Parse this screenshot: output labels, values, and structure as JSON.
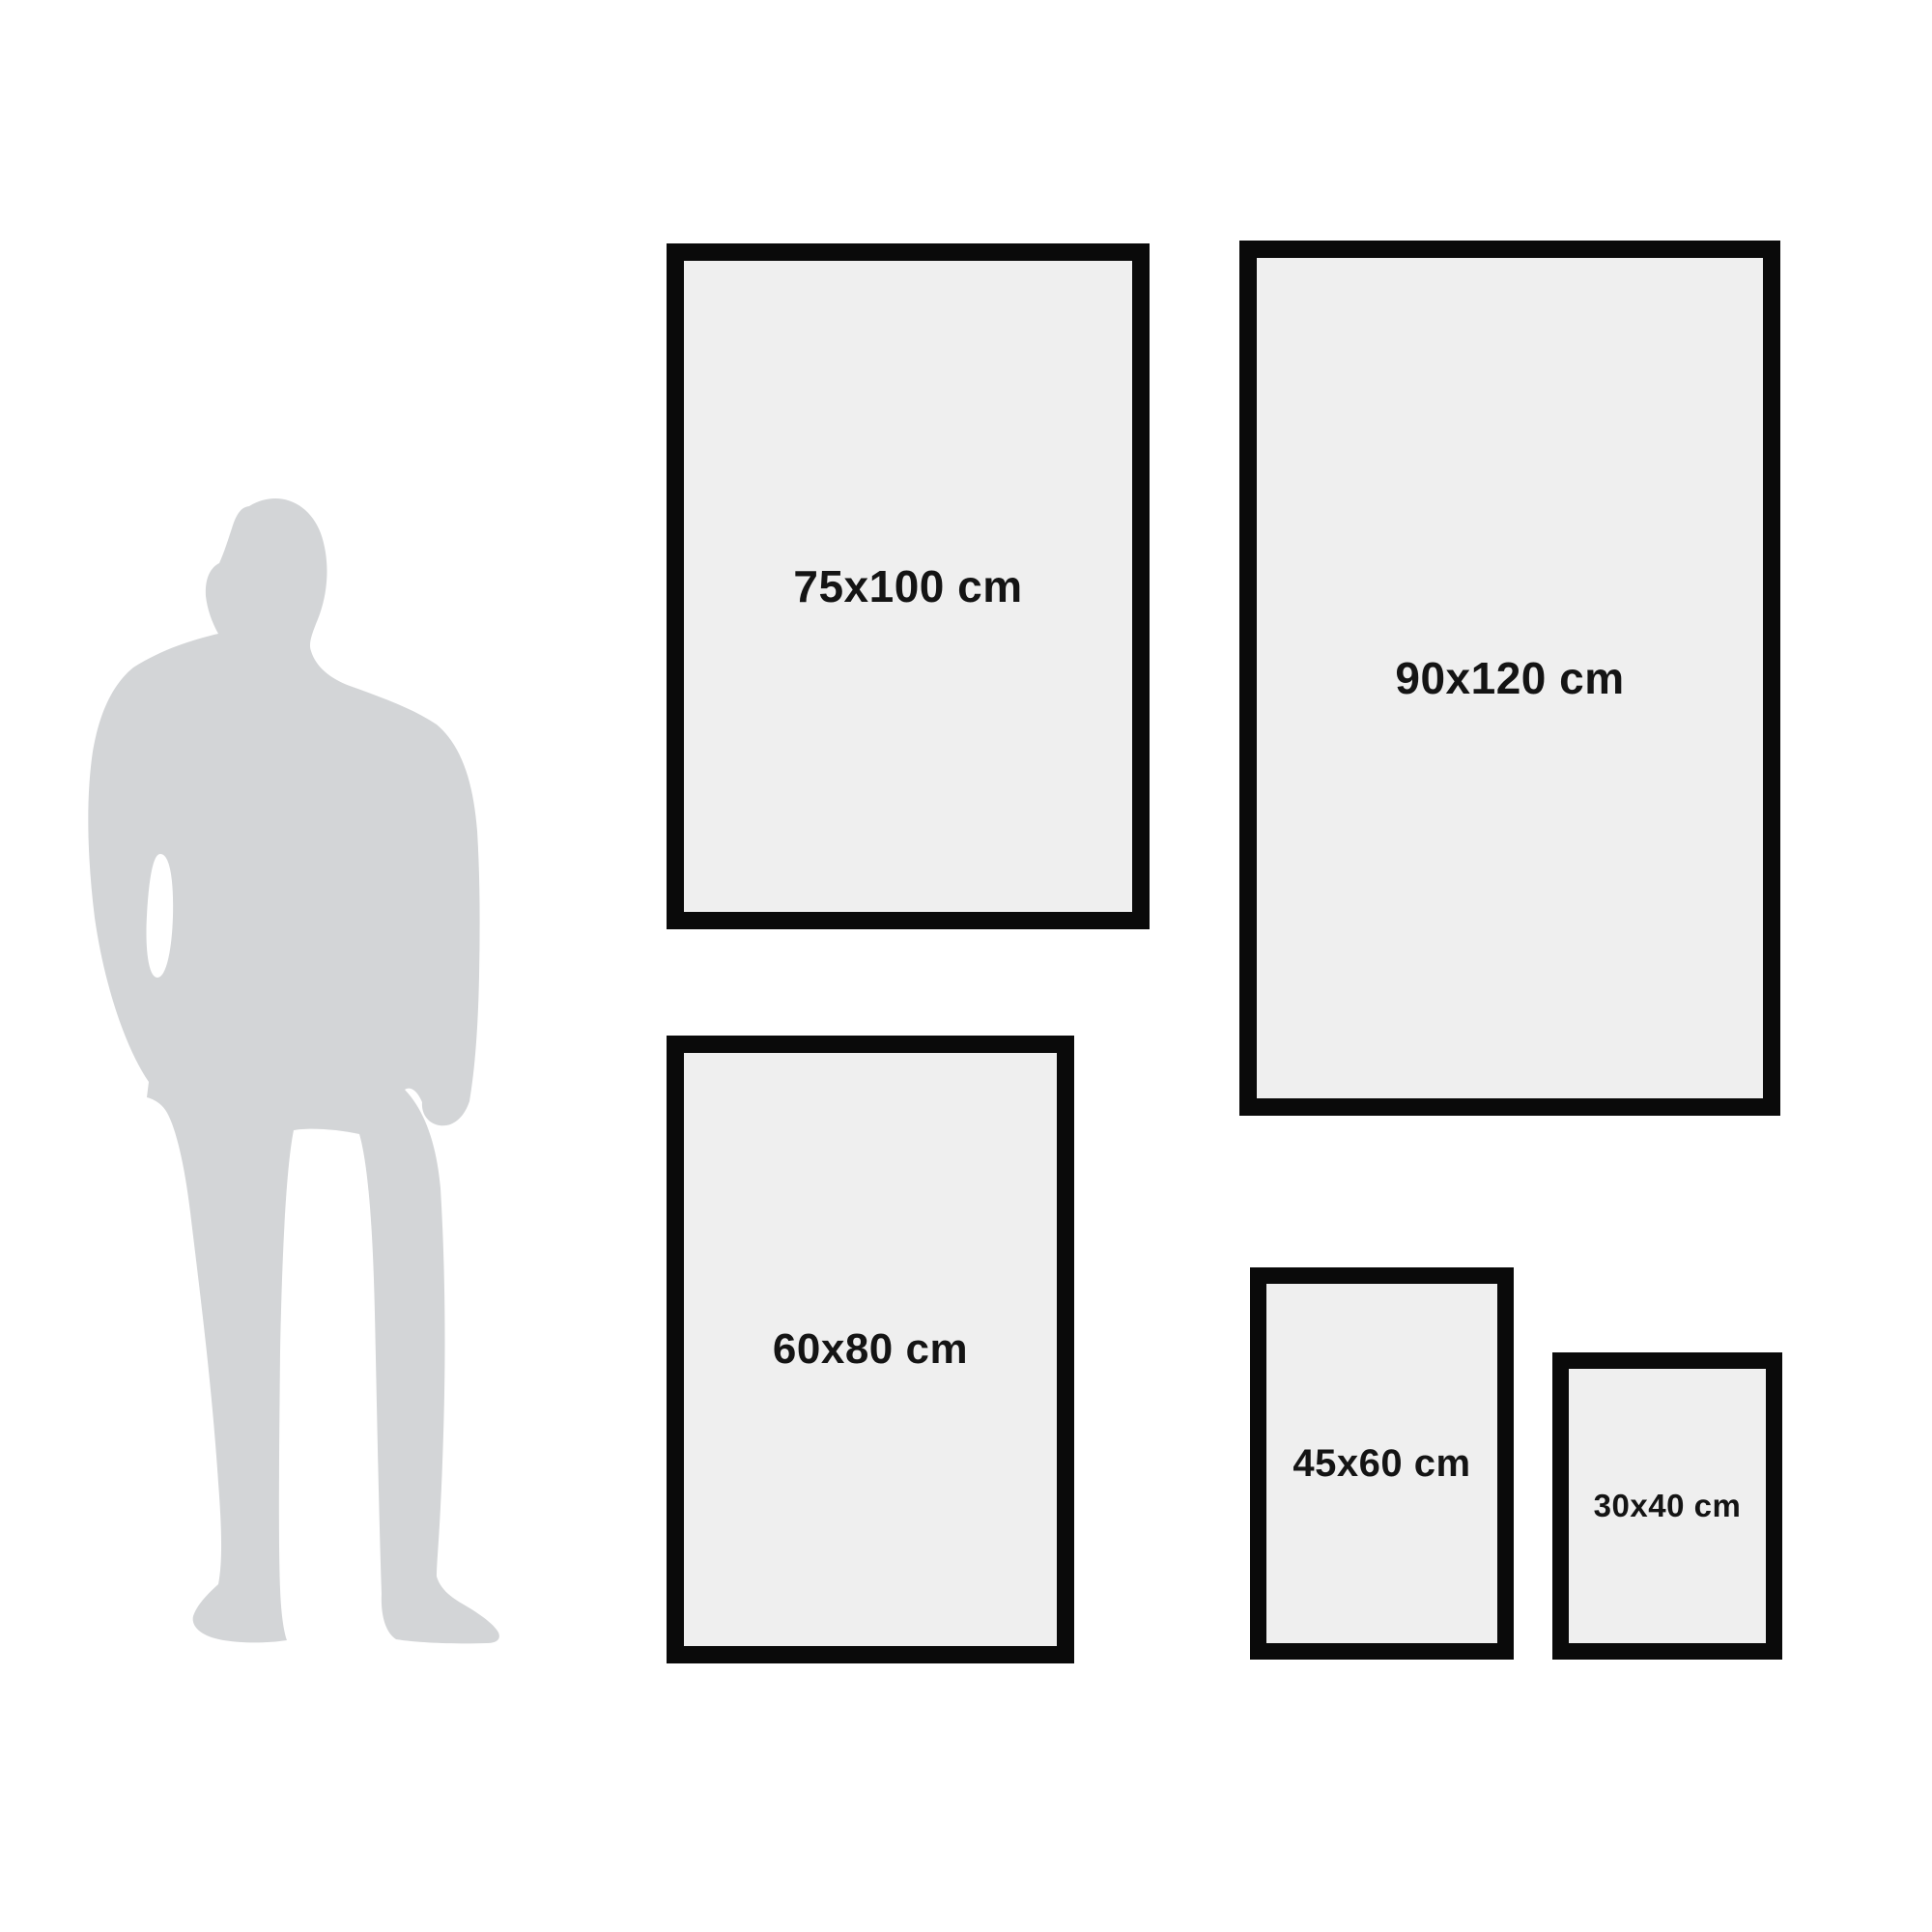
{
  "diagram": {
    "description": "Poster frame size comparison with human silhouette for scale",
    "silhouette_icon": "man-silhouette",
    "frames": [
      {
        "label": "75x100 cm",
        "width_cm": 75,
        "height_cm": 100
      },
      {
        "label": "90x120 cm",
        "width_cm": 90,
        "height_cm": 120
      },
      {
        "label": "60x80 cm",
        "width_cm": 60,
        "height_cm": 80
      },
      {
        "label": "45x60 cm",
        "width_cm": 45,
        "height_cm": 60
      },
      {
        "label": "30x40 cm",
        "width_cm": 30,
        "height_cm": 40
      }
    ],
    "colors": {
      "background": "#ffffff",
      "frame_border": "#0a0a0a",
      "frame_fill": "#efefef",
      "label_text": "#141414",
      "silhouette": "#d3d5d7"
    }
  }
}
